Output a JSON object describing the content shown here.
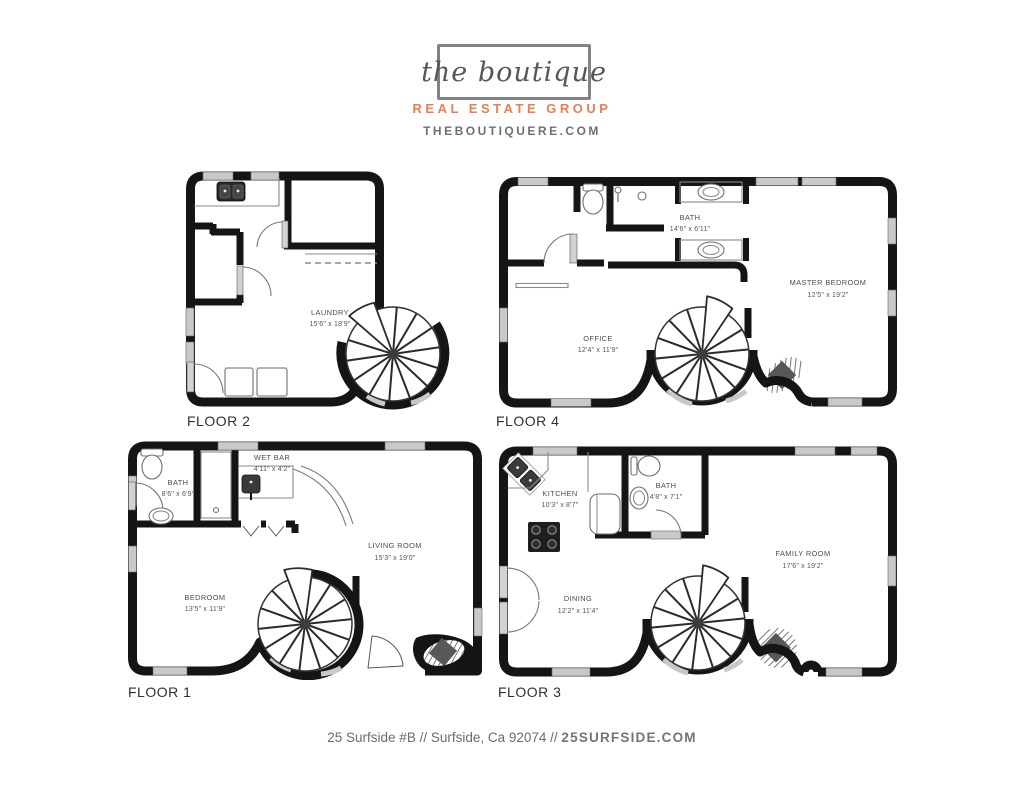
{
  "header": {
    "logo": "the boutique",
    "tagline": "REAL ESTATE GROUP",
    "website": "THEBOUTIQUERE.COM"
  },
  "colors": {
    "accent_orange": "#EF7C4E",
    "wall_black": "#151515",
    "window_gray": "#C9C9C9",
    "text_gray": "#55585A"
  },
  "floors": {
    "floor1": {
      "label": "FLOOR 1",
      "rooms": {
        "bath": {
          "name": "BATH",
          "dims": "8'6\" x 6'9\""
        },
        "wetbar": {
          "name": "WET BAR",
          "dims": "4'11\" x 4'2\""
        },
        "living": {
          "name": "LIVING ROOM",
          "dims": "15'3\" x 19'0\""
        },
        "bedroom": {
          "name": "BEDROOM",
          "dims": "13'5\" x 11'9\""
        }
      }
    },
    "floor2": {
      "label": "FLOOR 2",
      "rooms": {
        "laundry": {
          "name": "LAUNDRY",
          "dims": "15'6\" x 18'9\""
        }
      }
    },
    "floor3": {
      "label": "FLOOR 3",
      "rooms": {
        "kitchen": {
          "name": "KITCHEN",
          "dims": "10'3\" x 8'7\""
        },
        "bath": {
          "name": "BATH",
          "dims": "4'8\" x 7'1\""
        },
        "family": {
          "name": "FAMILY ROOM",
          "dims": "17'6\" x 19'2\""
        },
        "dining": {
          "name": "DINING",
          "dims": "12'2\" x 11'4\""
        }
      }
    },
    "floor4": {
      "label": "FLOOR 4",
      "rooms": {
        "bath": {
          "name": "BATH",
          "dims": "14'6\" x 6'11\""
        },
        "master": {
          "name": "MASTER BEDROOM",
          "dims": "12'5\" x 19'2\""
        },
        "office": {
          "name": "OFFICE",
          "dims": "12'4\" x 11'9\""
        }
      }
    }
  },
  "footer": {
    "address": "25 Surfside #B // Surfside, Ca 92074 // ",
    "site": "25SURFSIDE.COM"
  }
}
